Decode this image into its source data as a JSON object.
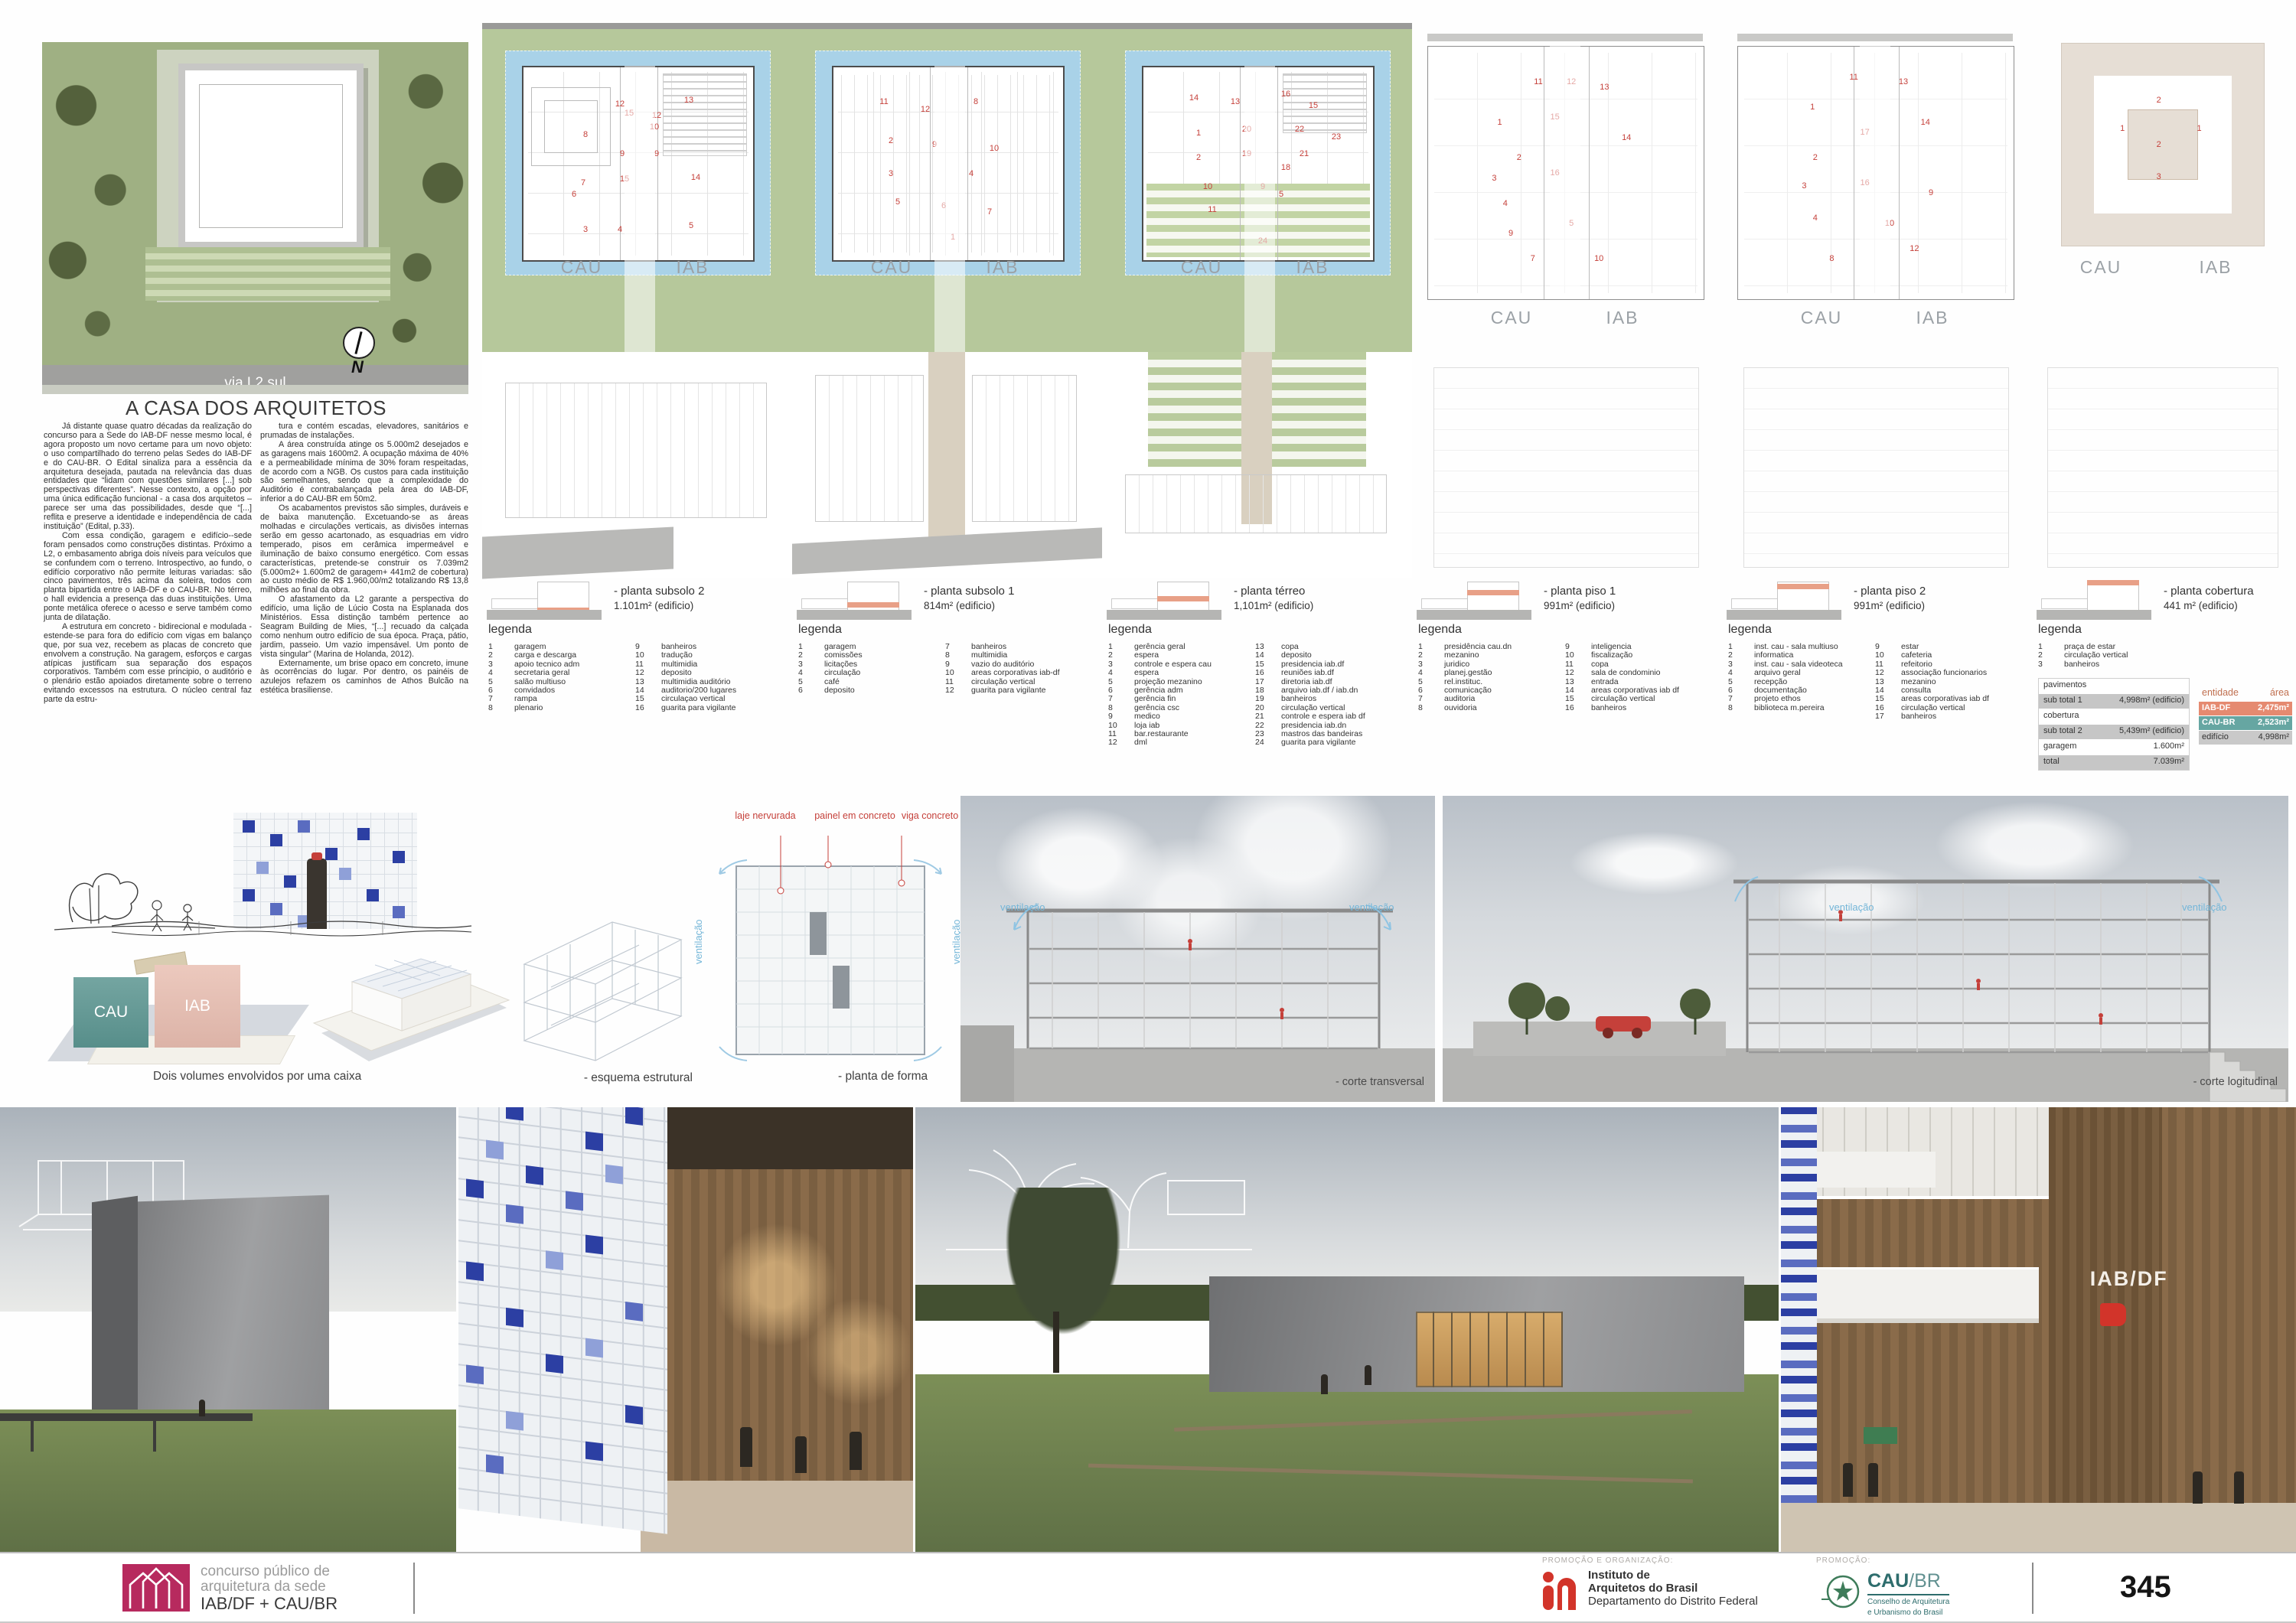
{
  "site": {
    "road_label": "via L2 sul",
    "north_label": "N"
  },
  "article": {
    "title": "A CASA DOS ARQUITETOS",
    "col1": [
      "Já distante quase quatro décadas da realização do concurso para a Sede do IAB-DF nesse mesmo local, é agora proposto um novo certame para um novo objeto: o uso compartilhado do terreno pelas Sedes do IAB-DF e do CAU-BR. O Edital sinaliza para a essência da arquitetura desejada, pautada na relevância das duas entidades que “lidam com questões similares [...] sob perspectivas diferentes”. Nesse contexto, a opção por uma única edificação funcional - a casa dos arquitetos – parece ser uma das possibilidades, desde que “[...] reflita e preserve a identidade e independência de cada instituição” (Edital, p.33).",
      "Com essa condição, garagem e edifício--sede foram pensados como construções distintas. Próximo a L2, o embasamento abriga dois níveis para veículos que se confundem com o terreno. Introspectivo, ao fundo, o edifício corporativo não permite leituras variadas: são cinco pavimentos, três acima da soleira, todos com planta bipartida entre o IAB-DF e o CAU-BR. No térreo, o hall evidencia a presença das duas instituições. Uma ponte metálica oferece o acesso e serve também como junta de dilatação.",
      "A estrutura em concreto - bidirecional e modulada - estende-se para fora do edifício com vigas em balanço que, por sua vez, recebem as placas de concreto que envolvem a construção. Na garagem, esforços e cargas atípicas justificam sua separação dos espaços corporativos. Também com esse principio, o auditório e o plenário estão apoiados diretamente sobre o terreno evitando excessos na estrutura. O núcleo central faz parte da estru-"
    ],
    "col2": [
      "tura e contém escadas, elevadores, sanitários e prumadas de instalações.",
      "A área construída atinge os 5.000m2 desejados e as garagens mais 1600m2. A ocupação máxima de 40% e a permeabilidade mínima de 30% foram respeitadas, de acordo com a NGB. Os custos para cada instituição são semelhantes, sendo que a complexidade do Auditório é contrabalançada pela área do IAB-DF, inferior a do CAU-BR em 50m2.",
      "Os acabamentos previstos são simples, duráveis e de baixa manutenção. Excetuando-se as áreas molhadas e circulações verticais, as divisões internas serão em gesso acartonado, as esquadrias em vidro temperado, pisos em cerâmica impermeável e iluminação de baixo consumo energético. Com essas características, pretende-se construir os 7.039m2 (5.000m2+ 1.600m2 de garagem+ 441m2 de cobertura) ao custo médio de R$ 1.960,00/m2 totalizando R$ 13,8 milhões ao final da obra.",
      "O afastamento da L2 garante a perspectiva do edifício, uma lição de Lúcio Costa na Esplanada dos Ministérios. Essa distinção também pertence ao Seagram Building de Mies, “[...] recuado da calçada como nenhum outro edifício de sua época. Praça, pátio, jardim, passeio. Um vazio impensável. Um ponto de vista singular” (Marina de Holanda, 2012).",
      "Externamente, um brise opaco em concreto, imune às ocorrências do lugar. Por dentro, os painéis de azulejos refazem os caminhos de Athos Bulcão na estética brasiliense."
    ]
  },
  "plan_labels": {
    "left": "CAU",
    "right": "IAB"
  },
  "labels": {
    "legenda": "legenda"
  },
  "plans": [
    {
      "caption": "- planta subsolo 2",
      "area": "1.101m² (edificio)",
      "legend_left": [
        {
          "n": "1",
          "label": "garagem"
        },
        {
          "n": "2",
          "label": "carga e descarga"
        },
        {
          "n": "3",
          "label": "apoio tecnico adm"
        },
        {
          "n": "4",
          "label": "secretaria geral"
        },
        {
          "n": "5",
          "label": "salão multiuso"
        },
        {
          "n": "6",
          "label": "convidados"
        },
        {
          "n": "7",
          "label": "rampa"
        },
        {
          "n": "8",
          "label": "plenario"
        }
      ],
      "legend_right": [
        {
          "n": "9",
          "label": "banheiros"
        },
        {
          "n": "10",
          "label": "tradução"
        },
        {
          "n": "11",
          "label": "multimidia"
        },
        {
          "n": "12",
          "label": "deposito"
        },
        {
          "n": "13",
          "label": "multimidia auditório"
        },
        {
          "n": "14",
          "label": "auditorio/200 lugares"
        },
        {
          "n": "15",
          "label": "circulaçao vertical"
        },
        {
          "n": "16",
          "label": "guarita para vigilante"
        }
      ],
      "markers": [
        {
          "t": "8",
          "x": 27,
          "y": 35
        },
        {
          "t": "15",
          "x": 46,
          "y": 24
        },
        {
          "t": "12",
          "x": 42,
          "y": 19
        },
        {
          "t": "13",
          "x": 72,
          "y": 17
        },
        {
          "t": "12",
          "x": 58,
          "y": 25
        },
        {
          "t": "10",
          "x": 57,
          "y": 31
        },
        {
          "t": "9",
          "x": 43,
          "y": 45
        },
        {
          "t": "9",
          "x": 58,
          "y": 45
        },
        {
          "t": "14",
          "x": 75,
          "y": 57
        },
        {
          "t": "7",
          "x": 26,
          "y": 60
        },
        {
          "t": "6",
          "x": 22,
          "y": 66
        },
        {
          "t": "15",
          "x": 44,
          "y": 58
        },
        {
          "t": "3",
          "x": 27,
          "y": 84
        },
        {
          "t": "4",
          "x": 42,
          "y": 84
        },
        {
          "t": "5",
          "x": 73,
          "y": 82
        }
      ]
    },
    {
      "caption": "- planta subsolo 1",
      "area": "814m² (edificio)",
      "legend_left": [
        {
          "n": "1",
          "label": "garagem"
        },
        {
          "n": "2",
          "label": "comissões"
        },
        {
          "n": "3",
          "label": "licitações"
        },
        {
          "n": "4",
          "label": "circulação"
        },
        {
          "n": "5",
          "label": "café"
        },
        {
          "n": "6",
          "label": "deposito"
        }
      ],
      "legend_right": [
        {
          "n": "7",
          "label": "banheiros"
        },
        {
          "n": "8",
          "label": "multimidia"
        },
        {
          "n": "9",
          "label": "vazio do auditório"
        },
        {
          "n": "10",
          "label": "areas corporativas iab-df"
        },
        {
          "n": "11",
          "label": "circulação vertical"
        },
        {
          "n": "12",
          "label": "guarita para vigilante"
        }
      ],
      "markers": [
        {
          "t": "11",
          "x": 22,
          "y": 18
        },
        {
          "t": "12",
          "x": 40,
          "y": 22
        },
        {
          "t": "8",
          "x": 62,
          "y": 18
        },
        {
          "t": "2",
          "x": 25,
          "y": 38
        },
        {
          "t": "9",
          "x": 44,
          "y": 40
        },
        {
          "t": "10",
          "x": 70,
          "y": 42
        },
        {
          "t": "3",
          "x": 25,
          "y": 55
        },
        {
          "t": "4",
          "x": 60,
          "y": 55
        },
        {
          "t": "5",
          "x": 28,
          "y": 70
        },
        {
          "t": "6",
          "x": 48,
          "y": 72
        },
        {
          "t": "1",
          "x": 52,
          "y": 88
        },
        {
          "t": "7",
          "x": 68,
          "y": 75
        }
      ]
    },
    {
      "caption": "- planta térreo",
      "area": "1,101m² (edificio)",
      "legend_left": [
        {
          "n": "1",
          "label": "gerência geral"
        },
        {
          "n": "2",
          "label": "espera"
        },
        {
          "n": "3",
          "label": "controle e espera cau"
        },
        {
          "n": "4",
          "label": "espera"
        },
        {
          "n": "5",
          "label": "projeção mezanino"
        },
        {
          "n": "6",
          "label": "gerência adm"
        },
        {
          "n": "7",
          "label": "gerência fin"
        },
        {
          "n": "8",
          "label": "gerência csc"
        },
        {
          "n": "9",
          "label": "medico"
        },
        {
          "n": "10",
          "label": "loja iab"
        },
        {
          "n": "11",
          "label": "bar.restaurante"
        },
        {
          "n": "12",
          "label": "dml"
        }
      ],
      "legend_right": [
        {
          "n": "13",
          "label": "copa"
        },
        {
          "n": "14",
          "label": "deposito"
        },
        {
          "n": "15",
          "label": "presidencia iab.df"
        },
        {
          "n": "16",
          "label": "reuniões iab.df"
        },
        {
          "n": "17",
          "label": "diretoria iab.df"
        },
        {
          "n": "18",
          "label": "arquivo iab.df / iab.dn"
        },
        {
          "n": "19",
          "label": "banheiros"
        },
        {
          "n": "20",
          "label": "circulação vertical"
        },
        {
          "n": "21",
          "label": "controle e espera iab df"
        },
        {
          "n": "22",
          "label": "presidencia iab.dn"
        },
        {
          "n": "23",
          "label": "mastros das bandeiras"
        },
        {
          "n": "24",
          "label": "guarita para vigilante"
        }
      ],
      "markers": [
        {
          "t": "14",
          "x": 22,
          "y": 16
        },
        {
          "t": "13",
          "x": 40,
          "y": 18
        },
        {
          "t": "16",
          "x": 62,
          "y": 14
        },
        {
          "t": "15",
          "x": 74,
          "y": 20
        },
        {
          "t": "1",
          "x": 24,
          "y": 34
        },
        {
          "t": "20",
          "x": 45,
          "y": 32
        },
        {
          "t": "22",
          "x": 68,
          "y": 32
        },
        {
          "t": "2",
          "x": 24,
          "y": 47
        },
        {
          "t": "19",
          "x": 45,
          "y": 45
        },
        {
          "t": "21",
          "x": 70,
          "y": 45
        },
        {
          "t": "18",
          "x": 62,
          "y": 52
        },
        {
          "t": "10",
          "x": 28,
          "y": 62
        },
        {
          "t": "11",
          "x": 30,
          "y": 74
        },
        {
          "t": "9",
          "x": 52,
          "y": 62
        },
        {
          "t": "5",
          "x": 60,
          "y": 66
        },
        {
          "t": "23",
          "x": 84,
          "y": 36
        },
        {
          "t": "24",
          "x": 52,
          "y": 90
        }
      ]
    },
    {
      "caption": "- planta piso 1",
      "area": "991m² (edificio)",
      "legend_left": [
        {
          "n": "1",
          "label": "presidência cau.dn"
        },
        {
          "n": "2",
          "label": "mezanino"
        },
        {
          "n": "3",
          "label": "juridico"
        },
        {
          "n": "4",
          "label": "planej.gestão"
        },
        {
          "n": "5",
          "label": "rel.instituc."
        },
        {
          "n": "6",
          "label": "comunicação"
        },
        {
          "n": "7",
          "label": "auditoria"
        },
        {
          "n": "8",
          "label": "ouvidoria"
        }
      ],
      "legend_right": [
        {
          "n": "9",
          "label": "inteligencia"
        },
        {
          "n": "10",
          "label": "fiscalização"
        },
        {
          "n": "11",
          "label": "copa"
        },
        {
          "n": "12",
          "label": "sala de condominio"
        },
        {
          "n": "13",
          "label": "entrada"
        },
        {
          "n": "14",
          "label": "areas corporativas iab df"
        },
        {
          "n": "15",
          "label": "circulação vertical"
        },
        {
          "n": "16",
          "label": "banheiros"
        }
      ],
      "markers": [
        {
          "t": "11",
          "x": 40,
          "y": 14
        },
        {
          "t": "12",
          "x": 52,
          "y": 14
        },
        {
          "t": "13",
          "x": 64,
          "y": 16
        },
        {
          "t": "1",
          "x": 26,
          "y": 30
        },
        {
          "t": "15",
          "x": 46,
          "y": 28
        },
        {
          "t": "14",
          "x": 72,
          "y": 36
        },
        {
          "t": "2",
          "x": 33,
          "y": 44
        },
        {
          "t": "3",
          "x": 24,
          "y": 52
        },
        {
          "t": "16",
          "x": 46,
          "y": 50
        },
        {
          "t": "4",
          "x": 28,
          "y": 62
        },
        {
          "t": "9",
          "x": 30,
          "y": 74
        },
        {
          "t": "7",
          "x": 38,
          "y": 84
        },
        {
          "t": "10",
          "x": 62,
          "y": 84
        },
        {
          "t": "5",
          "x": 52,
          "y": 70
        }
      ]
    },
    {
      "caption": "- planta piso 2",
      "area": "991m² (edificio)",
      "legend_left": [
        {
          "n": "1",
          "label": "inst. cau - sala multiuso"
        },
        {
          "n": "2",
          "label": "informatica"
        },
        {
          "n": "3",
          "label": "inst. cau - sala videoteca"
        },
        {
          "n": "4",
          "label": "arquivo geral"
        },
        {
          "n": "5",
          "label": "recepção"
        },
        {
          "n": "6",
          "label": "documentação"
        },
        {
          "n": "7",
          "label": "projeto ethos"
        },
        {
          "n": "8",
          "label": "biblioteca m.pereira"
        }
      ],
      "legend_right": [
        {
          "n": "9",
          "label": "estar"
        },
        {
          "n": "10",
          "label": "cafeteria"
        },
        {
          "n": "11",
          "label": "refeitorio"
        },
        {
          "n": "12",
          "label": "associação funcionarios"
        },
        {
          "n": "13",
          "label": "mezanino"
        },
        {
          "n": "14",
          "label": "consulta"
        },
        {
          "n": "15",
          "label": "areas corporativas iab df"
        },
        {
          "n": "16",
          "label": "circulação vertical"
        },
        {
          "n": "17",
          "label": "banheiros"
        }
      ],
      "markers": [
        {
          "t": "11",
          "x": 42,
          "y": 12
        },
        {
          "t": "13",
          "x": 60,
          "y": 14
        },
        {
          "t": "1",
          "x": 27,
          "y": 24
        },
        {
          "t": "17",
          "x": 46,
          "y": 34
        },
        {
          "t": "14",
          "x": 68,
          "y": 30
        },
        {
          "t": "2",
          "x": 28,
          "y": 44
        },
        {
          "t": "16",
          "x": 46,
          "y": 54
        },
        {
          "t": "9",
          "x": 70,
          "y": 58
        },
        {
          "t": "4",
          "x": 28,
          "y": 68
        },
        {
          "t": "3",
          "x": 24,
          "y": 55
        },
        {
          "t": "8",
          "x": 34,
          "y": 84
        },
        {
          "t": "12",
          "x": 64,
          "y": 80
        },
        {
          "t": "10",
          "x": 55,
          "y": 70
        }
      ]
    },
    {
      "caption": "- planta cobertura",
      "area": "441 m² (edificio)",
      "legend_left": [
        {
          "n": "1",
          "label": "praça de estar"
        },
        {
          "n": "2",
          "label": "circulação vertical"
        },
        {
          "n": "3",
          "label": "banheiros"
        }
      ],
      "legend_right": [],
      "markers": [
        {
          "t": "1",
          "x": 30,
          "y": 42
        },
        {
          "t": "2",
          "x": 48,
          "y": 28
        },
        {
          "t": "3",
          "x": 48,
          "y": 66
        },
        {
          "t": "1",
          "x": 68,
          "y": 42
        },
        {
          "t": "2",
          "x": 48,
          "y": 50
        }
      ]
    }
  ],
  "tables": {
    "pavimentos": {
      "header": "pavimentos",
      "rows": [
        [
          "sub total 1",
          "4,998m² (edificio)"
        ],
        [
          "cobertura",
          ""
        ],
        [
          "sub total 2",
          "5,439m² (edificio)"
        ],
        [
          "garagem",
          "1.600m²"
        ],
        [
          "total",
          "7.039m²"
        ]
      ]
    },
    "entidade": {
      "col1": "entidade",
      "col2": "área",
      "rows": [
        {
          "name": "IAB-DF",
          "area": "2,475m²",
          "color": "#e58a70"
        },
        {
          "name": "CAU-BR",
          "area": "2,523m²",
          "color": "#66a6a2"
        },
        {
          "name": "edifício",
          "area": "4,998m²",
          "color": "#c9c9c9"
        }
      ]
    }
  },
  "middle": {
    "volumes_caption": "Dois volumes envolvidos por uma caixa",
    "esquema_caption": "- esquema estrutural",
    "forma_caption": "- planta de forma",
    "laje_label": "laje nervurada",
    "painel_label": "painel em concreto",
    "viga_label": "viga concreto",
    "ventilacao_label": "ventilação",
    "corte1_caption": "- corte transversal",
    "corte2_caption": "- corte logitudinal"
  },
  "renders": {
    "interior_sign": "IAB/DF"
  },
  "footer": {
    "competition": {
      "line1": "concurso público de",
      "line2": "arquitetura da sede",
      "line3": "IAB/DF + CAU/BR"
    },
    "promo_org_label": "PROMOÇÃO E ORGANIZAÇÃO:",
    "iab": {
      "line1": "Instituto de",
      "line2": "Arquitetos do Brasil",
      "line3": "Departamento do Distrito Federal"
    },
    "promo_label": "PROMOÇÃO:",
    "cau": {
      "name_bold": "CAU",
      "name_light": "/BR",
      "sub1": "Conselho de Arquitetura",
      "sub2": "e Urbanismo do Brasil"
    },
    "page_number": "345"
  },
  "colors": {
    "accent_salmon": "#e58a70",
    "accent_teal": "#66a6a2",
    "logo_magenta": "#b72a5e",
    "iab_red": "#d2342a",
    "cau_teal": "#2e6d6d",
    "vent_blue": "#74b6d8",
    "annot_red": "#c5403a"
  }
}
